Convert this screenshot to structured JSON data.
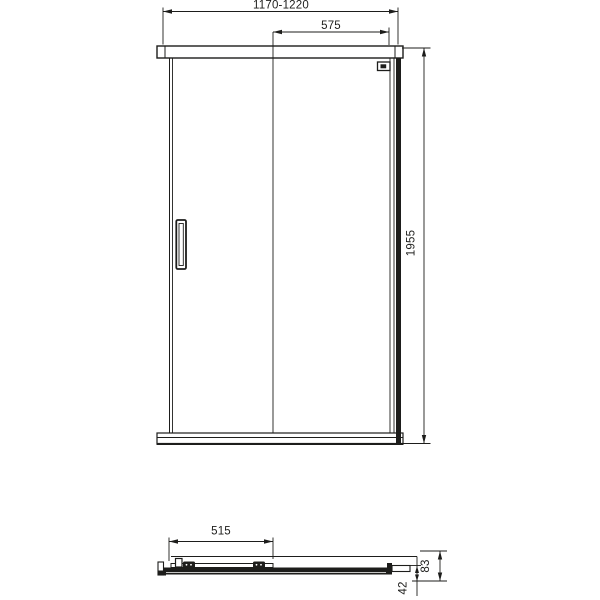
{
  "drawing": {
    "type": "shower-sliding-door-technical-drawing",
    "front_view": {
      "width_range_label": "1170-1220",
      "fixed_panel_width_label": "575",
      "height_label": "1955"
    },
    "plan_view": {
      "door_panel_width_label": "515",
      "profile_depth_label": "83",
      "rail_depth_label": "42"
    },
    "colors": {
      "line": "#1d1d1b",
      "background": "#ffffff"
    }
  }
}
